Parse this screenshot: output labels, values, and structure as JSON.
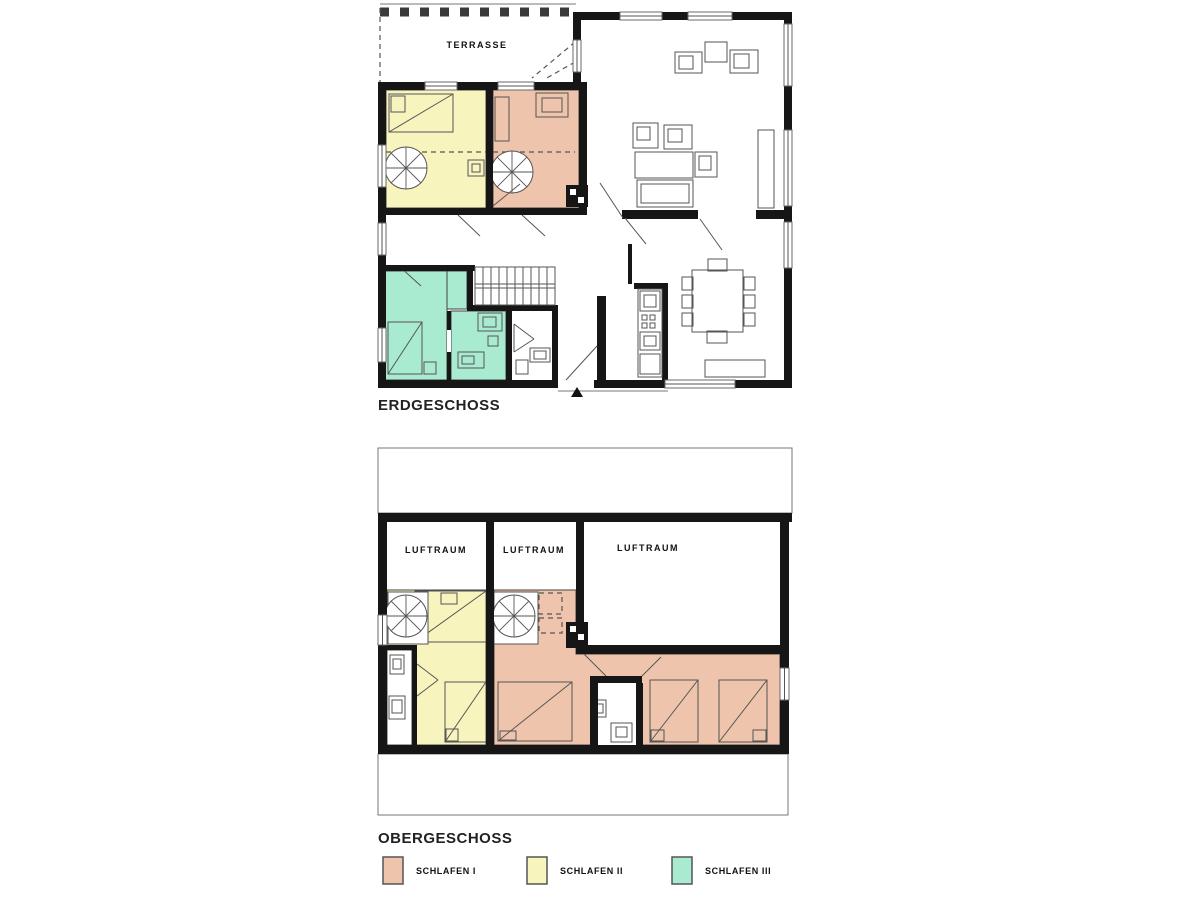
{
  "page": {
    "background": "#ffffff"
  },
  "colors": {
    "schlafen1": "#EFC4AC",
    "schlafen2": "#F7F4BE",
    "schlafen3": "#A9EBD1",
    "wall": "#161616"
  },
  "floor_plans": {
    "erdgeschoss": {
      "title": "ERDGESCHOSS",
      "terrace_label": "TERRASSE"
    },
    "obergeschoss": {
      "title": "OBERGESCHOSS",
      "void_label": "LUFTRAUM"
    }
  },
  "legend": {
    "items": [
      {
        "label": "SCHLAFEN I",
        "color": "#EFC4AC"
      },
      {
        "label": "SCHLAFEN II",
        "color": "#F7F4BE"
      },
      {
        "label": "SCHLAFEN III",
        "color": "#A9EBD1"
      }
    ]
  }
}
